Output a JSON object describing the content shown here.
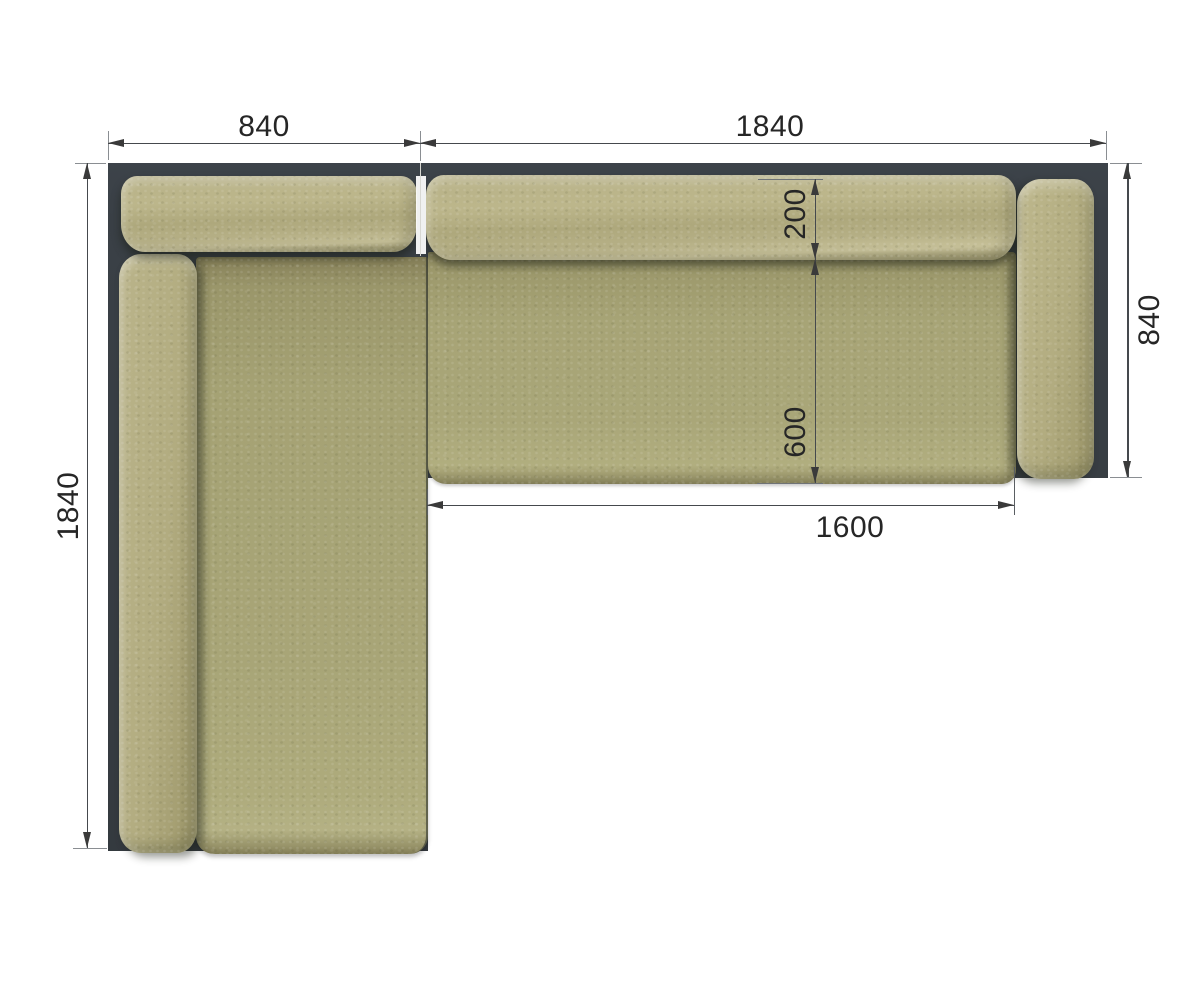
{
  "dims": {
    "chaise_width": "840",
    "main_width": "1840",
    "total_length_left": "1840",
    "side_depth_right": "840",
    "backrest_depth": "200",
    "seat_depth": "600",
    "seat_length": "1600"
  },
  "colors": {
    "frame": "#3a4046",
    "fabric": "#b3ad80",
    "fabric_seat": "#a7a476",
    "dim_line": "#45494d",
    "ext_line": "#8a8e92",
    "dim_text": "#262626",
    "background": "#ffffff"
  }
}
